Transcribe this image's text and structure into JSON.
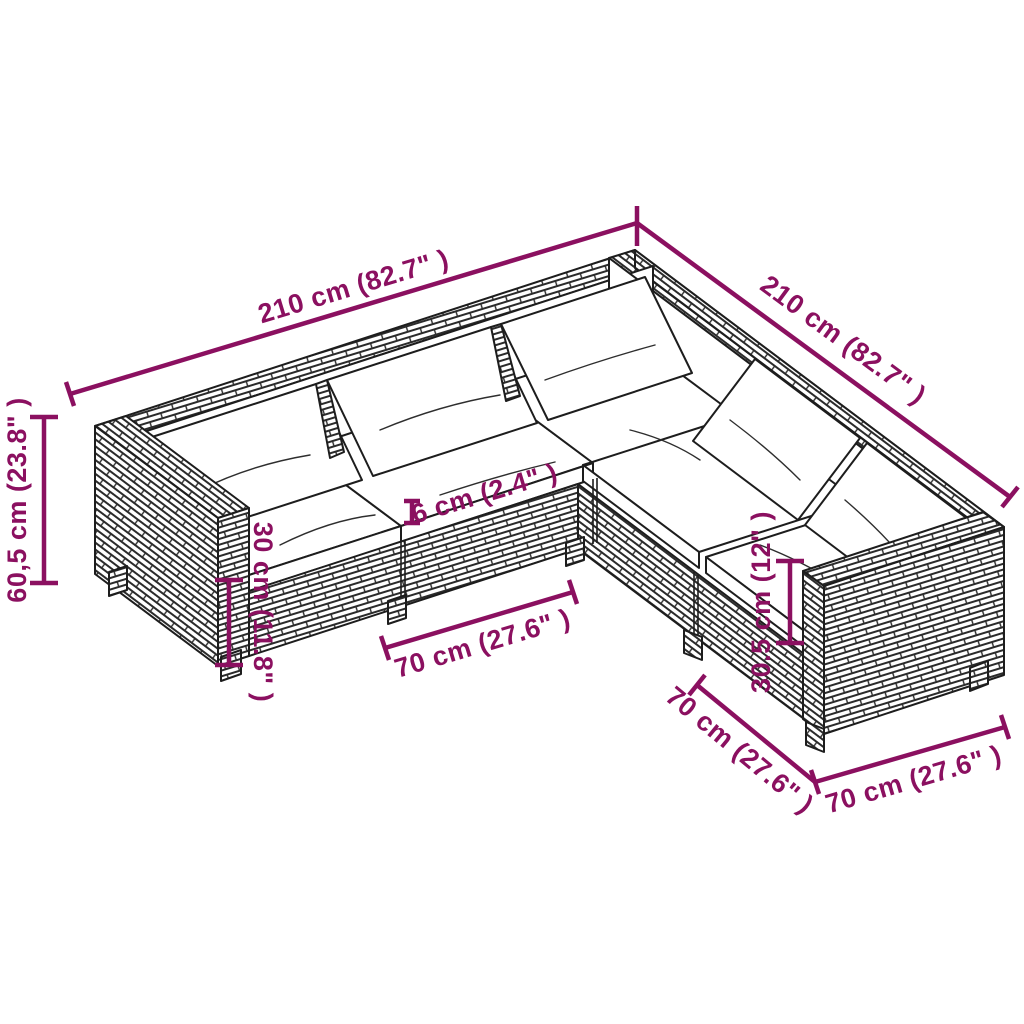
{
  "diagram": {
    "title": "5-piece rattan corner sofa set dimension diagram",
    "object": "l-shaped-garden-lounge-sofa",
    "background": "#ffffff",
    "line_color": "#1d1d1d",
    "dimension_color": "#8B1060",
    "labels": {
      "total_width_left": "210 cm (82.7\" )",
      "total_width_right": "210 cm (82.7\" )",
      "overall_height": "60,5 cm (23.8\" )",
      "seat_height": "30 cm (11.8\" )",
      "cushion_thickness": "6 cm (2.4\" )",
      "module_width_front": "70 cm (27.6\" )",
      "back_height": "30.5 cm (12\" )",
      "module_depth_right": "70 cm (27.6\" )",
      "module_width_right": "70 cm (27.6\" )"
    }
  }
}
